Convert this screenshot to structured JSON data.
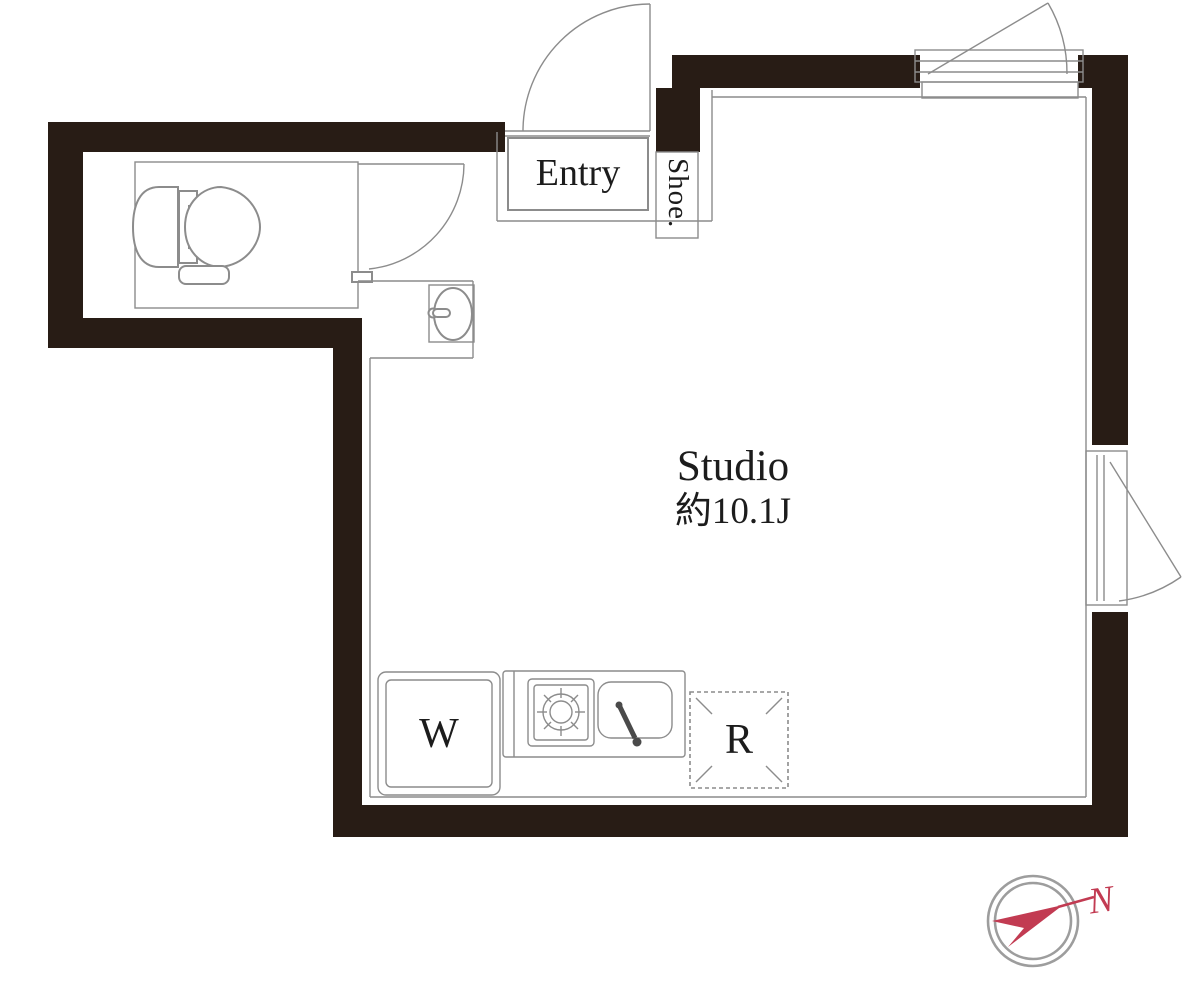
{
  "floor_plan": {
    "rooms": {
      "entry": {
        "label": "Entry"
      },
      "shoe_storage": {
        "label": "Shoe."
      },
      "studio": {
        "name": "Studio",
        "area": "約10.1J"
      }
    },
    "appliances": {
      "washer_label": "W",
      "refrigerator_label": "R"
    },
    "compass": {
      "north_label": "N"
    }
  },
  "colors": {
    "wall": "#281c15",
    "line": "#8c8c8c",
    "text": "#1c1c1c",
    "compass_red": "#c23b52",
    "compass_ring": "#9d9d9d"
  }
}
